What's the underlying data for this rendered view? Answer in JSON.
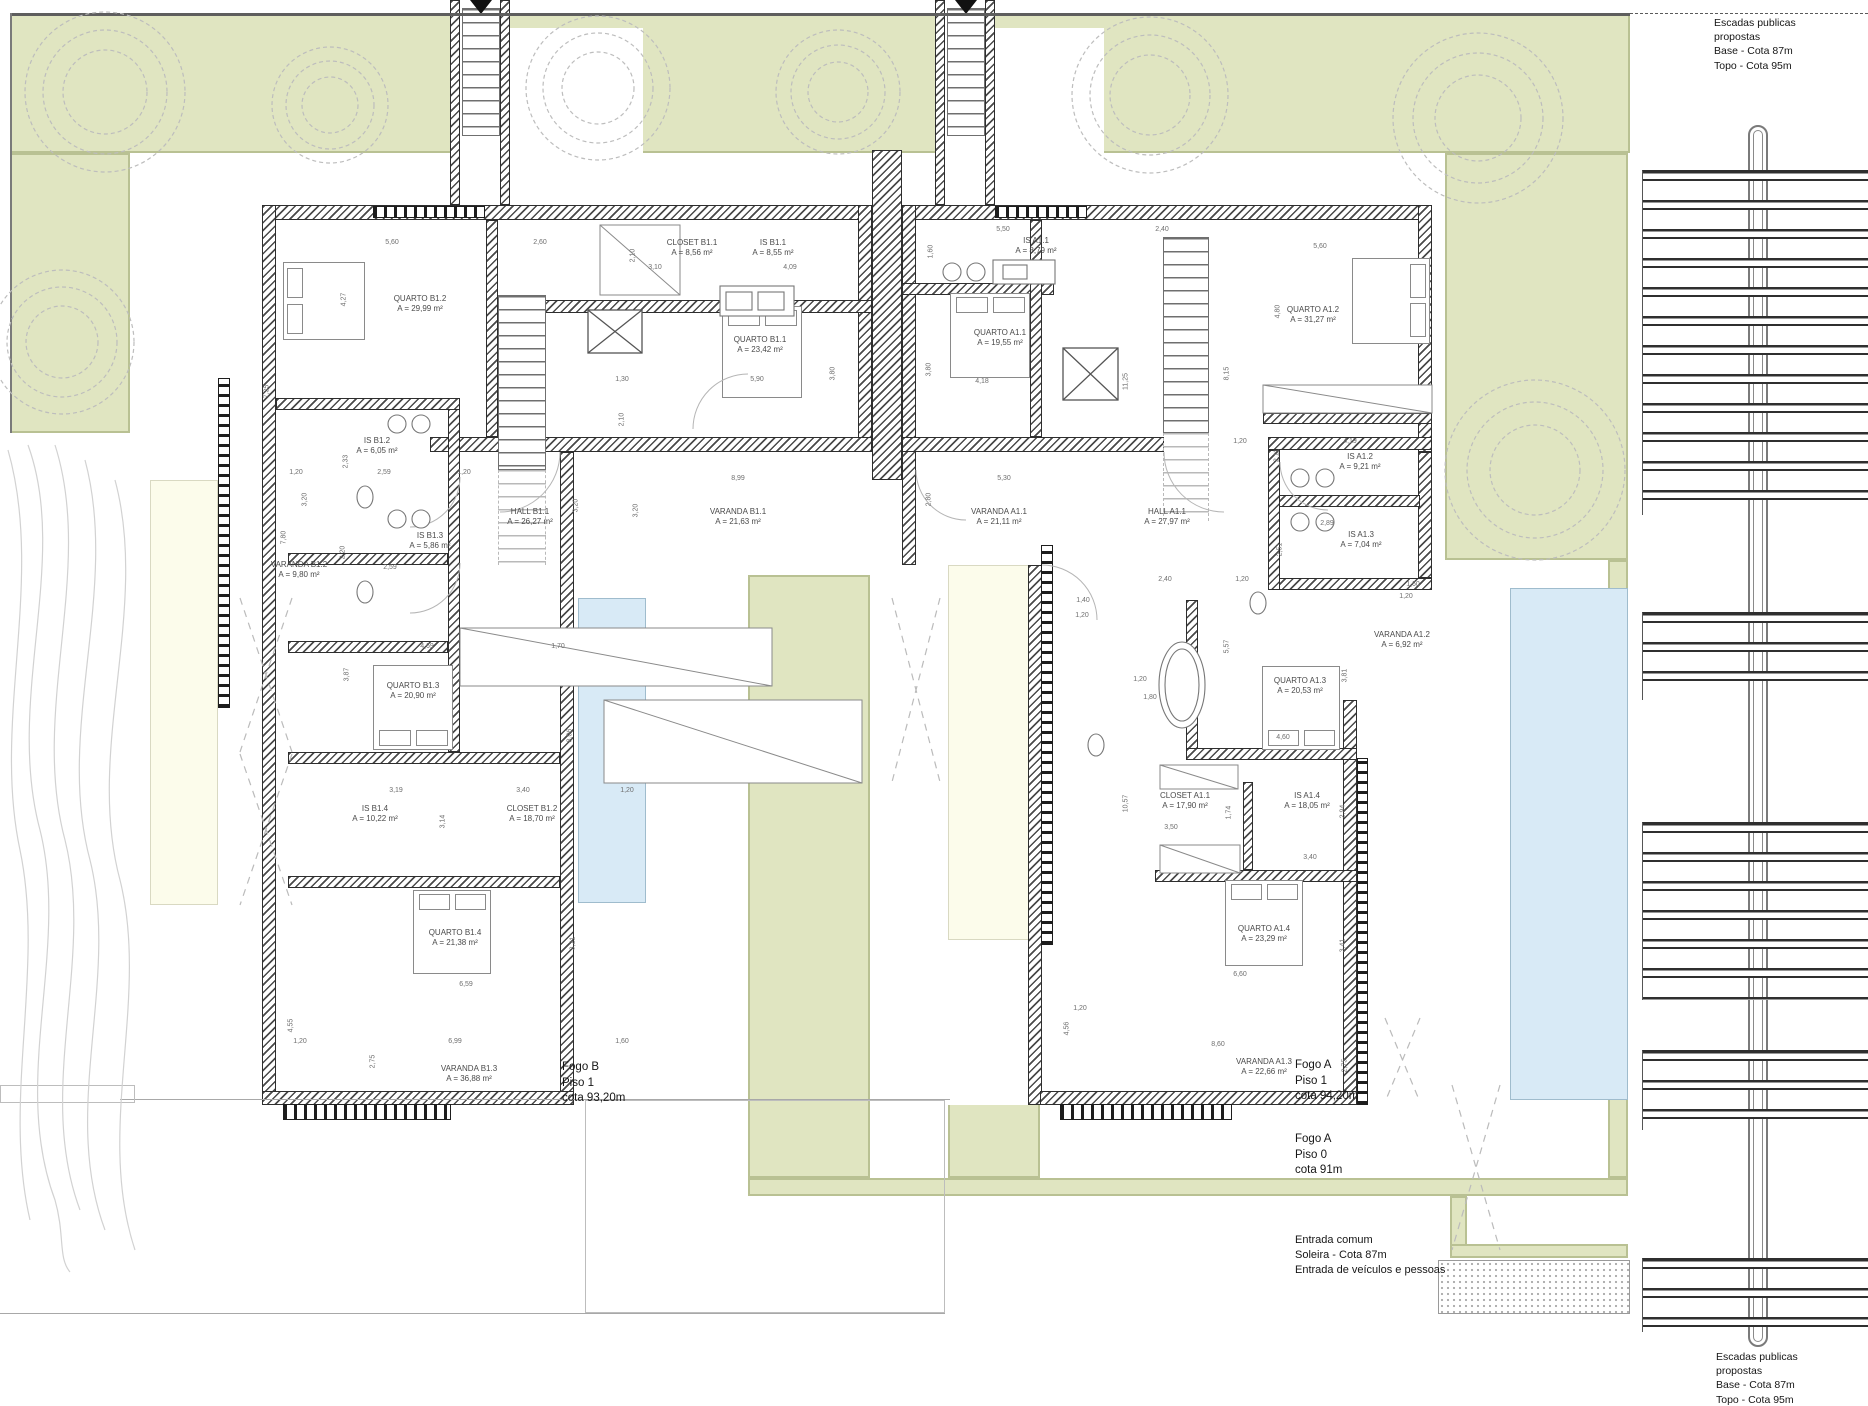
{
  "colors": {
    "garden_green": "#e0e5c1",
    "garden_border": "#b9c193",
    "pool_blue": "#d8eaf6",
    "patio_cream": "#fcfceb",
    "wall_dark": "#3c3c3c"
  },
  "houses": {
    "fogo_b": {
      "name": "Fogo B",
      "rooms": [
        {
          "id": "quarto-b12",
          "label": "QUARTO B1.2",
          "area": "A = 29,99 m²",
          "x": 420,
          "y": 303
        },
        {
          "id": "closet-b11",
          "label": "CLOSET B1.1",
          "area": "A = 8,56 m²",
          "x": 692,
          "y": 247
        },
        {
          "id": "is-b11",
          "label": "IS B1.1",
          "area": "A = 8,55 m²",
          "x": 773,
          "y": 247
        },
        {
          "id": "quarto-b11",
          "label": "QUARTO B1.1",
          "area": "A = 23,42 m²",
          "x": 760,
          "y": 344
        },
        {
          "id": "is-b12",
          "label": "IS B1.2",
          "area": "A = 6,05 m²",
          "x": 377,
          "y": 445
        },
        {
          "id": "is-b13",
          "label": "IS B1.3",
          "area": "A = 5,86 m²",
          "x": 430,
          "y": 540
        },
        {
          "id": "varanda-b12",
          "label": "VARANDA B1.2",
          "area": "A = 9,80 m²",
          "x": 299,
          "y": 569
        },
        {
          "id": "hall-b11",
          "label": "HALL B1.1",
          "area": "A = 26,27 m²",
          "x": 530,
          "y": 516
        },
        {
          "id": "varanda-b11",
          "label": "VARANDA B1.1",
          "area": "A = 21,63 m²",
          "x": 738,
          "y": 516
        },
        {
          "id": "quarto-b13",
          "label": "QUARTO B1.3",
          "area": "A = 20,90 m²",
          "x": 413,
          "y": 690
        },
        {
          "id": "is-b14",
          "label": "IS B1.4",
          "area": "A = 10,22 m²",
          "x": 375,
          "y": 813
        },
        {
          "id": "closet-b12",
          "label": "CLOSET B1.2",
          "area": "A = 18,70 m²",
          "x": 532,
          "y": 813
        },
        {
          "id": "quarto-b14",
          "label": "QUARTO B1.4",
          "area": "A = 21,38 m²",
          "x": 455,
          "y": 937
        },
        {
          "id": "varanda-b13",
          "label": "VARANDA B1.3",
          "area": "A = 36,88 m²",
          "x": 469,
          "y": 1073
        }
      ]
    },
    "fogo_a": {
      "name": "Fogo A",
      "rooms": [
        {
          "id": "is-a11",
          "label": "IS A1.1",
          "area": "A = 8,79 m²",
          "x": 1036,
          "y": 245
        },
        {
          "id": "quarto-a11",
          "label": "QUARTO A1.1",
          "area": "A = 19,55 m²",
          "x": 1000,
          "y": 337
        },
        {
          "id": "quarto-a12",
          "label": "QUARTO A1.2",
          "area": "A = 31,27 m²",
          "x": 1313,
          "y": 314
        },
        {
          "id": "varanda-a11",
          "label": "VARANDA A1.1",
          "area": "A = 21,11 m²",
          "x": 999,
          "y": 516
        },
        {
          "id": "hall-a11",
          "label": "HALL A1.1",
          "area": "A = 27,97 m²",
          "x": 1167,
          "y": 516
        },
        {
          "id": "is-a12",
          "label": "IS A1.2",
          "area": "A = 9,21 m²",
          "x": 1360,
          "y": 461
        },
        {
          "id": "is-a13",
          "label": "IS A1.3",
          "area": "A = 7,04 m²",
          "x": 1361,
          "y": 539
        },
        {
          "id": "varanda-a12",
          "label": "VARANDA A1.2",
          "area": "A = 6,92 m²",
          "x": 1402,
          "y": 639
        },
        {
          "id": "quarto-a13",
          "label": "QUARTO A1.3",
          "area": "A = 20,53 m²",
          "x": 1300,
          "y": 685
        },
        {
          "id": "closet-a11",
          "label": "CLOSET A1.1",
          "area": "A = 17,90 m²",
          "x": 1185,
          "y": 800
        },
        {
          "id": "is-a14",
          "label": "IS A1.4",
          "area": "A = 18,05 m²",
          "x": 1307,
          "y": 800
        },
        {
          "id": "quarto-a14",
          "label": "QUARTO A1.4",
          "area": "A = 23,29 m²",
          "x": 1264,
          "y": 933
        },
        {
          "id": "varanda-a13",
          "label": "VARANDA A1.3",
          "area": "A = 22,66 m²",
          "x": 1264,
          "y": 1066
        }
      ]
    }
  },
  "notes": [
    {
      "id": "escadas-publicas-top",
      "x": 1714,
      "y": 16,
      "size": 10.5,
      "lines": [
        "Escadas publicas",
        "propostas",
        "Base - Cota 87m",
        "Topo - Cota 95m"
      ]
    },
    {
      "id": "escadas-publicas-bottom",
      "x": 1716,
      "y": 1350,
      "size": 10.5,
      "lines": [
        "Escadas publicas",
        "propostas",
        "Base - Cota 87m",
        "Topo - Cota 95m"
      ]
    },
    {
      "id": "fogo-b-level",
      "x": 562,
      "y": 1060,
      "size": 11.5,
      "lines": [
        "Fogo B",
        "Piso 1",
        "cota 93,20m"
      ]
    },
    {
      "id": "fogo-a-piso1",
      "x": 1295,
      "y": 1058,
      "size": 11.5,
      "lines": [
        "Fogo A",
        "Piso 1",
        "cota 94,20m"
      ]
    },
    {
      "id": "fogo-a-piso0",
      "x": 1295,
      "y": 1132,
      "size": 11.5,
      "lines": [
        "Fogo A",
        "Piso 0",
        "cota 91m"
      ]
    },
    {
      "id": "entrada-comum",
      "x": 1295,
      "y": 1233,
      "size": 11,
      "lines": [
        "Entrada comum",
        "Soleira - Cota 87m",
        "Entrada de veículos e pessoas"
      ]
    }
  ],
  "dims": [
    [
      "5,60",
      392,
      243,
      0
    ],
    [
      "2,60",
      540,
      243,
      0
    ],
    [
      "4,27",
      344,
      300,
      1
    ],
    [
      "7,35",
      267,
      392,
      1
    ],
    [
      "2,10",
      633,
      256,
      1
    ],
    [
      "3,10",
      655,
      268,
      0
    ],
    [
      "4,09",
      790,
      268,
      0
    ],
    [
      "1,30",
      622,
      380,
      0
    ],
    [
      "5,90",
      757,
      380,
      0
    ],
    [
      "3,80",
      833,
      374,
      1
    ],
    [
      "2,10",
      622,
      420,
      1
    ],
    [
      "1,20",
      296,
      473,
      0
    ],
    [
      "2,59",
      384,
      473,
      0
    ],
    [
      "1,20",
      464,
      473,
      0
    ],
    [
      "2,33",
      346,
      462,
      1
    ],
    [
      "3,20",
      305,
      500,
      1
    ],
    [
      "3,20",
      576,
      506,
      1
    ],
    [
      "7,80",
      284,
      538,
      1
    ],
    [
      "2,20",
      343,
      553,
      1
    ],
    [
      "2,59",
      390,
      568,
      0
    ],
    [
      "8,99",
      738,
      479,
      0
    ],
    [
      "5,30",
      1004,
      479,
      0
    ],
    [
      "3,20",
      636,
      511,
      1
    ],
    [
      "2,80",
      929,
      500,
      1
    ],
    [
      "4,69",
      427,
      647,
      0
    ],
    [
      "1,70",
      558,
      647,
      0
    ],
    [
      "3,87",
      347,
      675,
      1
    ],
    [
      "8,06",
      570,
      736,
      1
    ],
    [
      "3,19",
      396,
      791,
      0
    ],
    [
      "3,40",
      523,
      791,
      0
    ],
    [
      "1,20",
      627,
      791,
      0
    ],
    [
      "3,14",
      443,
      822,
      1
    ],
    [
      "6,59",
      466,
      985,
      0
    ],
    [
      "3,21",
      573,
      944,
      1
    ],
    [
      "1,20",
      300,
      1042,
      0
    ],
    [
      "6,99",
      455,
      1042,
      0
    ],
    [
      "1,60",
      622,
      1042,
      0
    ],
    [
      "2,75",
      373,
      1062,
      1
    ],
    [
      "4,55",
      291,
      1026,
      1
    ],
    [
      "5,50",
      1003,
      230,
      0
    ],
    [
      "2,40",
      1162,
      230,
      0
    ],
    [
      "5,60",
      1320,
      247,
      0
    ],
    [
      "1,60",
      931,
      252,
      1
    ],
    [
      "3,80",
      929,
      370,
      1
    ],
    [
      "4,18",
      982,
      382,
      0
    ],
    [
      "11,25",
      1126,
      382,
      1
    ],
    [
      "8,15",
      1227,
      374,
      1
    ],
    [
      "4,80",
      1278,
      312,
      1
    ],
    [
      "1,20",
      1240,
      442,
      0
    ],
    [
      "4,19",
      1350,
      442,
      0
    ],
    [
      "2,11",
      1277,
      456,
      1
    ],
    [
      "2,89",
      1327,
      524,
      0
    ],
    [
      "2,51",
      1280,
      550,
      1
    ],
    [
      "2,40",
      1165,
      580,
      0
    ],
    [
      "1,20",
      1242,
      580,
      0
    ],
    [
      "1,40",
      1083,
      601,
      0
    ],
    [
      "1,20",
      1082,
      616,
      0
    ],
    [
      "1,60",
      1413,
      585,
      0
    ],
    [
      "1,20",
      1406,
      597,
      0
    ],
    [
      "5,57",
      1227,
      647,
      1
    ],
    [
      "1,20",
      1140,
      680,
      0
    ],
    [
      "1,80",
      1150,
      698,
      0
    ],
    [
      "3,81",
      1345,
      676,
      1
    ],
    [
      "4,60",
      1283,
      738,
      0
    ],
    [
      "10,57",
      1126,
      804,
      1
    ],
    [
      "1,74",
      1229,
      813,
      1
    ],
    [
      "3,50",
      1171,
      828,
      0
    ],
    [
      "2,94",
      1343,
      812,
      1
    ],
    [
      "3,40",
      1310,
      858,
      0
    ],
    [
      "3,41",
      1343,
      946,
      1
    ],
    [
      "6,60",
      1240,
      975,
      0
    ],
    [
      "1,20",
      1080,
      1009,
      0
    ],
    [
      "8,60",
      1218,
      1045,
      0
    ],
    [
      "2,75",
      1345,
      1066,
      1
    ],
    [
      "4,56",
      1067,
      1029,
      1
    ]
  ]
}
